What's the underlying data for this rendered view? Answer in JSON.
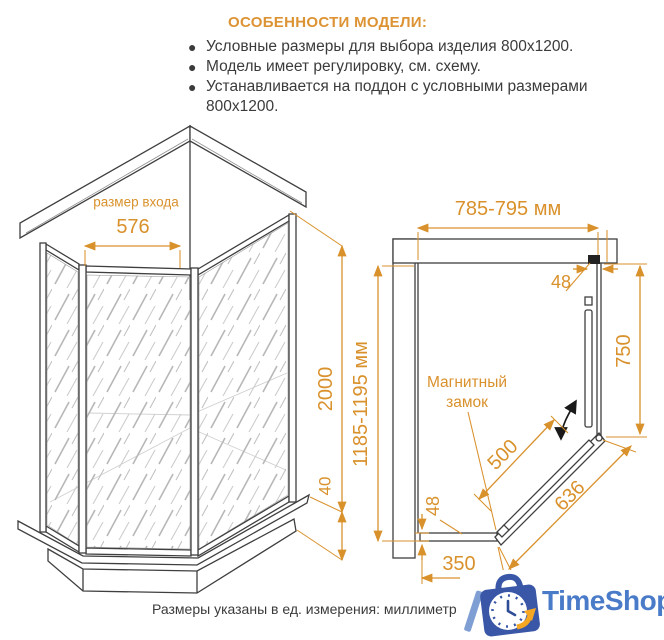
{
  "features": {
    "title": "ОСОБЕННОСТИ МОДЕЛИ:",
    "bullets": [
      "Условные размеры для выбора изделия 800x1200.",
      "Модель имеет регулировку, см. схему.",
      "Устанавливается на поддон с условными размерами 800x1200."
    ]
  },
  "iso_view": {
    "entry_label": "размер входа",
    "entry_width": "576",
    "height": "2000",
    "tray_height": "40"
  },
  "plan_view": {
    "width_range": "785-795 мм",
    "depth_range": "1185-1195 мм",
    "profile_top": "48",
    "side_panel": "750",
    "magnet_label_1": "Магнитный",
    "magnet_label_2": "замок",
    "door_width": "500",
    "diagonal": "636",
    "profile_bottom": "48",
    "bottom_panel": "350"
  },
  "footer": {
    "note": "Размеры указаны в ед. измерения: миллиметр"
  },
  "logo": {
    "text": "TimeShop"
  },
  "colors": {
    "accent_orange": "#DD9333",
    "dim_orange": "#D9912C",
    "text_dark": "#3B3B3B",
    "line_dark": "#3F3F3F",
    "logo_blue": "#4A7BC8",
    "logo_bag": "#3A57A7",
    "logo_arrow": "#F5A623"
  }
}
